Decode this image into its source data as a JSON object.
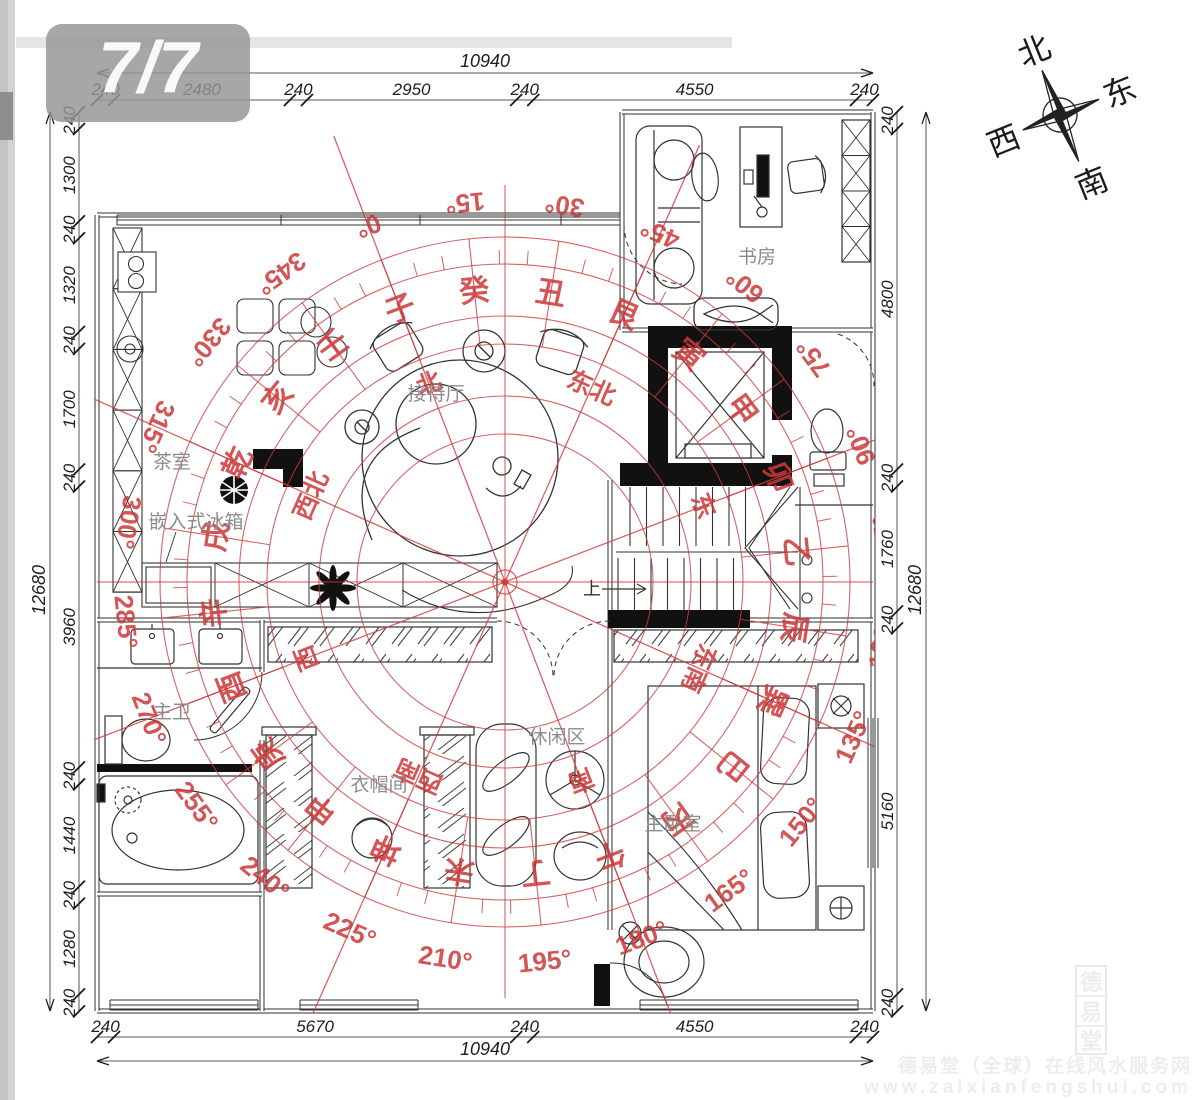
{
  "badge": {
    "text": "7/7"
  },
  "plan": {
    "rooms": {
      "study": "书房",
      "reception": "接待厅",
      "tea_room": "茶室",
      "built_in_fridge": "嵌入式冰箱",
      "master_bath": "主卫",
      "cloakroom": "衣帽间",
      "leisure_area": "休闲区",
      "master_bedroom": "主卧室",
      "stairs_up": "上"
    }
  },
  "dimensions": {
    "top": {
      "total": "10940",
      "segments": [
        240,
        2480,
        240,
        2950,
        240,
        4550,
        240
      ]
    },
    "bottom": {
      "total": "10940",
      "segments": [
        240,
        5670,
        240,
        4550,
        240
      ]
    },
    "left": {
      "total": "12680",
      "segments": [
        240,
        1300,
        240,
        1320,
        240,
        1700,
        240,
        3960,
        240,
        1440,
        240,
        1280,
        240
      ]
    },
    "right": {
      "total": "12680",
      "segments": [
        240,
        4800,
        240,
        1760,
        240,
        5160,
        240
      ]
    }
  },
  "luopan": {
    "rotation_deg": -21,
    "degrees": [
      "0°",
      "15°",
      "30°",
      "45°",
      "60°",
      "75°",
      "90°",
      "105°",
      "120°",
      "135°",
      "150°",
      "165°",
      "180°",
      "195°",
      "210°",
      "225°",
      "240°",
      "255°",
      "270°",
      "285°",
      "300°",
      "315°",
      "330°",
      "345°"
    ],
    "mountains": [
      "子",
      "癸",
      "丑",
      "艮",
      "寅",
      "甲",
      "卯",
      "乙",
      "辰",
      "巽",
      "巳",
      "丙",
      "午",
      "丁",
      "未",
      "坤",
      "申",
      "庚",
      "酉",
      "辛",
      "戌",
      "乾",
      "亥",
      "壬"
    ],
    "directions": [
      "北",
      "东北",
      "东",
      "东南",
      "南",
      "西南",
      "西",
      "西北"
    ]
  },
  "compass_rose": {
    "north": "北",
    "east": "东",
    "south": "南",
    "west": "西"
  },
  "watermark": {
    "seal_chars": [
      "德",
      "易",
      "堂"
    ],
    "line1": "德易堂（全球）在线风水服务网",
    "line2": "www.zaixianfengshui.com"
  },
  "colors": {
    "luopan_red": "#cc3838",
    "plan_black": "#333333",
    "label_gray": "#8c8c8c",
    "badge_gray": "#969696",
    "watermark_gray": "#ededed"
  }
}
